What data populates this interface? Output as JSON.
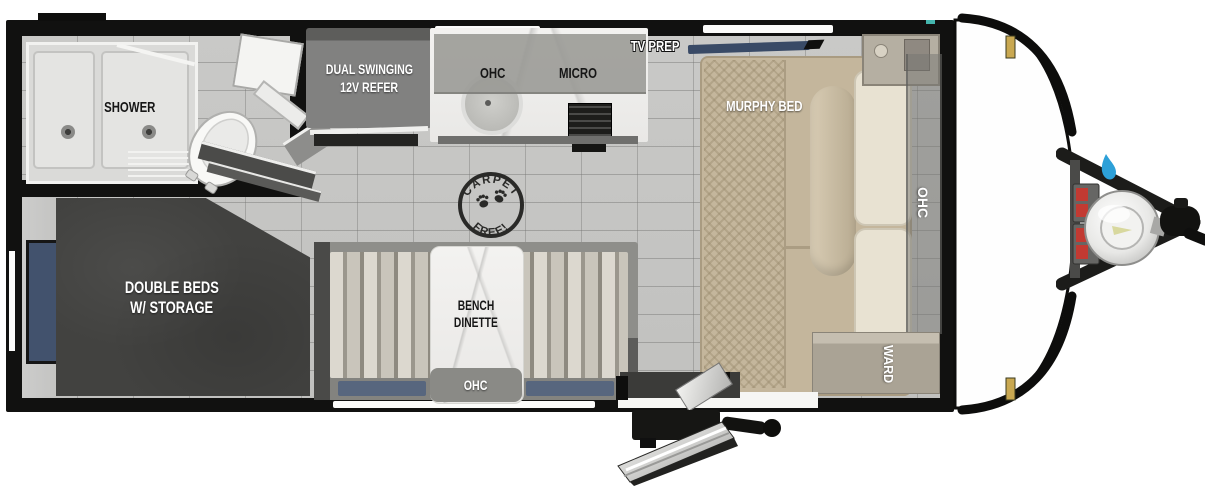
{
  "rooms": {
    "bathroom": {
      "shower": "SHOWER"
    },
    "kitchen": {
      "refrigerator_line1": "DUAL SWINGING",
      "refrigerator_line2": "12V REFER",
      "overhead_cabinet": "OHC",
      "microwave": "MICRO"
    },
    "living": {
      "tv_prep": "TV PREP",
      "murphy_bed": "MURPHY BED",
      "overhead_cabinet": "OHC",
      "wardrobe": "WARD"
    },
    "bedroom": {
      "line1": "DOUBLE BEDS",
      "line2": "W/ STORAGE"
    },
    "dinette": {
      "line1": "BENCH",
      "line2": "DINETTE",
      "overhead_cabinet": "OHC"
    },
    "badge": {
      "top": "CARPET",
      "bottom": "FREE!"
    }
  },
  "colors": {
    "wall": "#111110",
    "floor_tile": "#c6c6c4",
    "bed_charcoal": "#42423f",
    "window_blue": "#47566f",
    "tv_navy": "#394a66",
    "murphy_tan": "#c4b69c",
    "cushion_cream": "#e8e2d2",
    "hitch_red": "#c23a32",
    "flame_blue": "#2da0d8",
    "cap_gold": "#c9a851"
  }
}
